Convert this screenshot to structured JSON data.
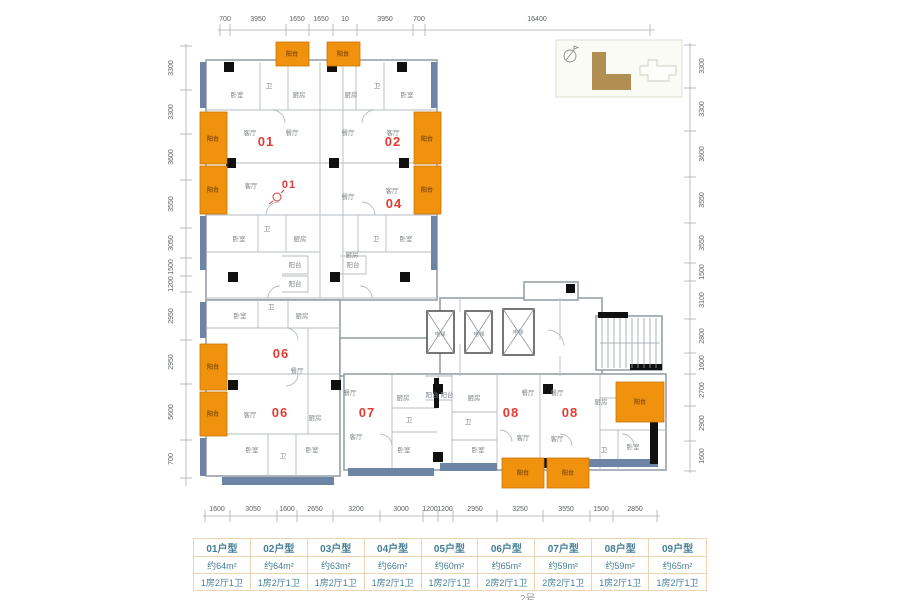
{
  "title": {
    "building": "2号"
  },
  "colors": {
    "accent_orange": "#f0920d",
    "unit_red": "#e23b33",
    "slate": "#6e84a6",
    "wood": "#b18f52",
    "table_text": "#447e95",
    "table_border": "#ecd3b4"
  },
  "dims": {
    "top": {
      "labels": [
        {
          "v": "700",
          "x": 225
        },
        {
          "v": "3950",
          "x": 258
        },
        {
          "v": "1650",
          "x": 297
        },
        {
          "v": "1650",
          "x": 321
        },
        {
          "v": "10",
          "x": 345
        },
        {
          "v": "3950",
          "x": 385
        },
        {
          "v": "700",
          "x": 419
        },
        {
          "v": "16400",
          "x": 537
        }
      ],
      "ticks": [
        220,
        230,
        286,
        309,
        333,
        357,
        413,
        425,
        650
      ],
      "y": 30
    },
    "bottom": {
      "labels": [
        {
          "v": "1600",
          "x": 217
        },
        {
          "v": "3050",
          "x": 253
        },
        {
          "v": "1600",
          "x": 287
        },
        {
          "v": "2650",
          "x": 315
        },
        {
          "v": "3200",
          "x": 356
        },
        {
          "v": "3000",
          "x": 401
        },
        {
          "v": "1200",
          "x": 430
        },
        {
          "v": "1200",
          "x": 445
        },
        {
          "v": "2950",
          "x": 475
        },
        {
          "v": "3250",
          "x": 520
        },
        {
          "v": "3550",
          "x": 566
        },
        {
          "v": "1500",
          "x": 601
        },
        {
          "v": "2850",
          "x": 635
        }
      ],
      "ticks": [
        205,
        230,
        277,
        297,
        333,
        380,
        423,
        438,
        453,
        497,
        543,
        590,
        613,
        657
      ],
      "y": 516
    },
    "left": {
      "labels": [
        {
          "v": "3300",
          "y": 68
        },
        {
          "v": "3300",
          "y": 112
        },
        {
          "v": "3600",
          "y": 157
        },
        {
          "v": "3550",
          "y": 204
        },
        {
          "v": "3050",
          "y": 243
        },
        {
          "v": "1500",
          "y": 267
        },
        {
          "v": "1200",
          "y": 284
        },
        {
          "v": "2950",
          "y": 316
        },
        {
          "v": "2950",
          "y": 362
        },
        {
          "v": "5600",
          "y": 412
        },
        {
          "v": "700",
          "y": 459
        }
      ],
      "ticks": [
        46,
        90,
        134,
        180,
        228,
        258,
        276,
        292,
        340,
        384,
        440,
        478
      ],
      "x": 186
    },
    "right": {
      "labels": [
        {
          "v": "3300",
          "y": 66
        },
        {
          "v": "3300",
          "y": 109
        },
        {
          "v": "3600",
          "y": 154
        },
        {
          "v": "3550",
          "y": 200
        },
        {
          "v": "3550",
          "y": 243
        },
        {
          "v": "1500",
          "y": 272
        },
        {
          "v": "3100",
          "y": 300
        },
        {
          "v": "2800",
          "y": 336
        },
        {
          "v": "1600",
          "y": 363
        },
        {
          "v": "2700",
          "y": 390
        },
        {
          "v": "2900",
          "y": 423
        },
        {
          "v": "1600",
          "y": 456
        }
      ],
      "ticks": [
        45,
        88,
        131,
        177,
        223,
        263,
        281,
        319,
        353,
        374,
        406,
        441,
        471
      ],
      "x": 690
    }
  },
  "plan": {
    "balconies": [
      {
        "x": 276,
        "y": 42,
        "w": 33,
        "h": 24,
        "label": "阳台",
        "lx": 292,
        "ly": 56
      },
      {
        "x": 327,
        "y": 42,
        "w": 33,
        "h": 24,
        "label": "阳台",
        "lx": 343,
        "ly": 56
      },
      {
        "x": 200,
        "y": 112,
        "w": 27,
        "h": 52,
        "label": "阳台",
        "lx": 213,
        "ly": 141
      },
      {
        "x": 200,
        "y": 166,
        "w": 27,
        "h": 48,
        "label": "阳台",
        "lx": 213,
        "ly": 192
      },
      {
        "x": 414,
        "y": 112,
        "w": 27,
        "h": 52,
        "label": "阳台",
        "lx": 427,
        "ly": 141
      },
      {
        "x": 414,
        "y": 166,
        "w": 27,
        "h": 48,
        "label": "阳台",
        "lx": 427,
        "ly": 192
      },
      {
        "x": 200,
        "y": 344,
        "w": 27,
        "h": 46,
        "label": "阳台",
        "lx": 213,
        "ly": 369
      },
      {
        "x": 200,
        "y": 392,
        "w": 27,
        "h": 44,
        "label": "阳台",
        "lx": 213,
        "ly": 416
      },
      {
        "x": 502,
        "y": 458,
        "w": 42,
        "h": 30,
        "label": "阳台",
        "lx": 523,
        "ly": 475
      },
      {
        "x": 547,
        "y": 458,
        "w": 42,
        "h": 30,
        "label": "阳台",
        "lx": 568,
        "ly": 475
      },
      {
        "x": 616,
        "y": 382,
        "w": 48,
        "h": 40,
        "label": "阳台",
        "lx": 640,
        "ly": 404
      }
    ],
    "rooms": [
      {
        "t": "卧室",
        "x": 237,
        "y": 97
      },
      {
        "t": "卫",
        "x": 269,
        "y": 88
      },
      {
        "t": "厨房",
        "x": 299,
        "y": 97
      },
      {
        "t": "厨房",
        "x": 351,
        "y": 97
      },
      {
        "t": "卫",
        "x": 377,
        "y": 88
      },
      {
        "t": "卧室",
        "x": 407,
        "y": 97
      },
      {
        "t": "客厅",
        "x": 250,
        "y": 135
      },
      {
        "t": "餐厅",
        "x": 292,
        "y": 135
      },
      {
        "t": "餐厅",
        "x": 348,
        "y": 135
      },
      {
        "t": "客厅",
        "x": 393,
        "y": 135
      },
      {
        "t": "客厅",
        "x": 251,
        "y": 188
      },
      {
        "t": "餐厅",
        "x": 348,
        "y": 199
      },
      {
        "t": "客厅",
        "x": 392,
        "y": 193
      },
      {
        "t": "卧室",
        "x": 239,
        "y": 241
      },
      {
        "t": "卫",
        "x": 267,
        "y": 231
      },
      {
        "t": "厨房",
        "x": 300,
        "y": 241
      },
      {
        "t": "阳台",
        "x": 295,
        "y": 267
      },
      {
        "t": "阳台",
        "x": 295,
        "y": 286
      },
      {
        "t": "厨房",
        "x": 352,
        "y": 257
      },
      {
        "t": "卫",
        "x": 376,
        "y": 241
      },
      {
        "t": "卧室",
        "x": 406,
        "y": 241
      },
      {
        "t": "阳台",
        "x": 353,
        "y": 267
      },
      {
        "t": "卧室",
        "x": 240,
        "y": 318
      },
      {
        "t": "卫",
        "x": 271,
        "y": 309
      },
      {
        "t": "厨房",
        "x": 302,
        "y": 318
      },
      {
        "t": "餐厅",
        "x": 297,
        "y": 373
      },
      {
        "t": "客厅",
        "x": 250,
        "y": 417
      },
      {
        "t": "厨房",
        "x": 315,
        "y": 420
      },
      {
        "t": "卧室",
        "x": 252,
        "y": 452
      },
      {
        "t": "卫",
        "x": 283,
        "y": 458
      },
      {
        "t": "卧室",
        "x": 312,
        "y": 452
      },
      {
        "t": "餐厅",
        "x": 350,
        "y": 395
      },
      {
        "t": "客厅",
        "x": 356,
        "y": 439
      },
      {
        "t": "厨房",
        "x": 403,
        "y": 400
      },
      {
        "t": "卫",
        "x": 409,
        "y": 422
      },
      {
        "t": "卧室",
        "x": 404,
        "y": 452
      },
      {
        "t": "阳台",
        "x": 432,
        "y": 397
      },
      {
        "t": "阳台",
        "x": 447,
        "y": 397
      },
      {
        "t": "厨房",
        "x": 474,
        "y": 400
      },
      {
        "t": "卫",
        "x": 468,
        "y": 424
      },
      {
        "t": "卧室",
        "x": 478,
        "y": 452
      },
      {
        "t": "餐厅",
        "x": 528,
        "y": 395
      },
      {
        "t": "客厅",
        "x": 523,
        "y": 440
      },
      {
        "t": "餐厅",
        "x": 557,
        "y": 395
      },
      {
        "t": "客厅",
        "x": 557,
        "y": 441
      },
      {
        "t": "厨房",
        "x": 601,
        "y": 404
      },
      {
        "t": "卫",
        "x": 604,
        "y": 452
      },
      {
        "t": "卧室",
        "x": 633,
        "y": 449
      }
    ],
    "units": [
      {
        "n": "01",
        "x": 266,
        "y": 146,
        "s": 13
      },
      {
        "n": "02",
        "x": 393,
        "y": 146,
        "s": 13
      },
      {
        "n": "01",
        "x": 289,
        "y": 188,
        "s": 11
      },
      {
        "n": "04",
        "x": 394,
        "y": 208,
        "s": 13
      },
      {
        "n": "06",
        "x": 281,
        "y": 358,
        "s": 13
      },
      {
        "n": "06",
        "x": 280,
        "y": 417,
        "s": 13
      },
      {
        "n": "07",
        "x": 367,
        "y": 417,
        "s": 13
      },
      {
        "n": "08",
        "x": 511,
        "y": 417,
        "s": 13
      },
      {
        "n": "08",
        "x": 570,
        "y": 417,
        "s": 13
      }
    ],
    "elevators": [
      {
        "t": "电梯",
        "x": 440,
        "y": 336
      },
      {
        "t": "电梯",
        "x": 479,
        "y": 336
      },
      {
        "t": "电梯",
        "x": 518,
        "y": 334
      }
    ]
  },
  "table": {
    "units": [
      {
        "type": "01户型",
        "area": "约64m²",
        "layout": "1房2厅1卫"
      },
      {
        "type": "02户型",
        "area": "约64m²",
        "layout": "1房2厅1卫"
      },
      {
        "type": "03户型",
        "area": "约63m²",
        "layout": "1房2厅1卫"
      },
      {
        "type": "04户型",
        "area": "约66m²",
        "layout": "1房2厅1卫"
      },
      {
        "type": "05户型",
        "area": "约60m²",
        "layout": "1房2厅1卫"
      },
      {
        "type": "06户型",
        "area": "约65m²",
        "layout": "2房2厅1卫"
      },
      {
        "type": "07户型",
        "area": "约59m²",
        "layout": "2房2厅1卫"
      },
      {
        "type": "08户型",
        "area": "约59m²",
        "layout": "1房2厅1卫"
      },
      {
        "type": "09户型",
        "area": "约65m²",
        "layout": "1房2厅1卫"
      }
    ]
  }
}
